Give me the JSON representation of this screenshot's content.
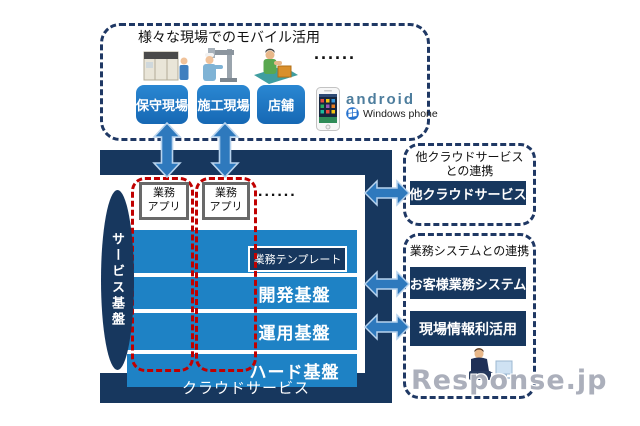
{
  "colors": {
    "navy": "#17375e",
    "panel_blue": "#1e82c5",
    "site_blue": "#1c77c8",
    "dashed_red": "#c00000",
    "arrow_fill": "#2e79bd",
    "arrow_stroke": "#b7d3ee",
    "android_gray_blue": "#4d7d9d",
    "watermark_gray": "#9499a8"
  },
  "mobile_zone": {
    "title": "様々な現場でのモバイル活用",
    "dots": "......",
    "sites": [
      {
        "label": "保守現場"
      },
      {
        "label": "施工現場"
      },
      {
        "label": "店舗"
      }
    ],
    "platforms": {
      "android_label": "android",
      "windows_phone_label": "Windows phone"
    }
  },
  "cloud_platform": {
    "app_chip": {
      "line1": "業務",
      "line2": "アプリ"
    },
    "dots": "......",
    "service_base_label": "サービス基盤",
    "template_label": "業務テンプレート",
    "layers": [
      "開発基盤",
      "運用基盤",
      "ハード基盤"
    ],
    "footer_label": "クラウドサービス"
  },
  "right_panel": {
    "cloud_link": {
      "title_line1": "他クラウドサービス",
      "title_line2": "との連携",
      "box_label": "他クラウドサービス"
    },
    "system_link": {
      "title": "業務システムとの連携",
      "box1_label": "お客様業務システム",
      "box2_label": "現場情報利活用"
    }
  },
  "watermark": "Response.jp"
}
